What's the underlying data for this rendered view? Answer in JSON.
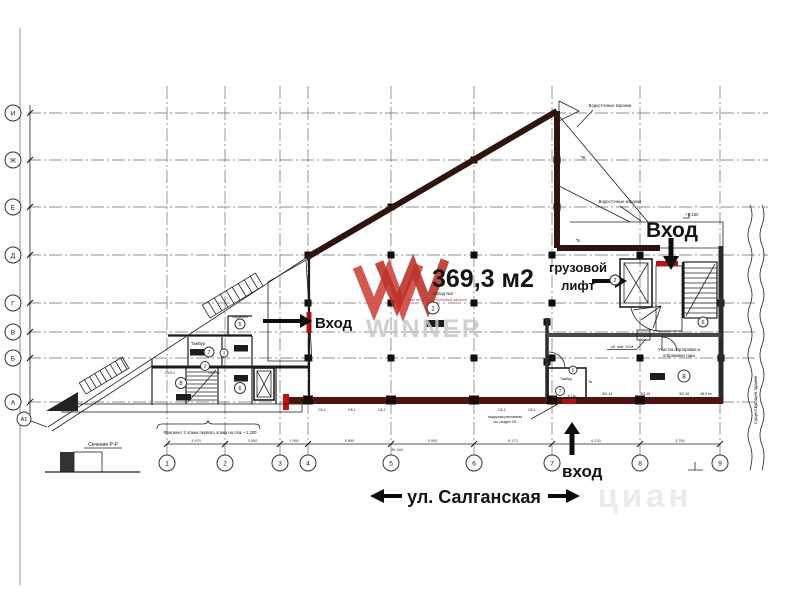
{
  "plan": {
    "area_label": "369,3 м2",
    "entrance_left": "Вход",
    "entrance_top": "Вход",
    "entrance_bottom": "вход",
    "freight_line1": "грузовой",
    "freight_line2": "лифт",
    "street_label": "ул. Салганская",
    "section_label": "Сечение Р-Р",
    "fragment_note": "Фрагмент 2 этажа первого этажа на отм. +1,200",
    "drain_note_1": "Водосточные воронки",
    "drain_note_2": "Водосточные воронки",
    "sorting_line1": "Участок сортировки и",
    "sorting_line2": "отбраковки тары",
    "tambur_left": "Тамбур",
    "tambur_right": "Тамбур",
    "garderob": "Гардероб",
    "skl1": "СКЛ-1",
    "skl12": "СКЛ-12",
    "existing_building": "Существующее здание",
    "elevation_mark": "+0,150",
    "sign_line1": "наружная рекламная",
    "sign_line2": "см. раздел СВ",
    "ob_pov": "об. пов. 2СМ",
    "area_small": "48,9 м²",
    "area_small2": "4,1 м²",
    "eo14": "ЭО-14",
    "eo15": "ЭО-15",
    "eo16": "ЭО-16",
    "tv1": "Тв",
    "tv2": "Тв",
    "tk1": "Тк"
  },
  "watermark": {
    "brand": "WINNER",
    "sub": "Склад №2",
    "disclaimer": "план не является публичной офертой",
    "faint": "циан"
  },
  "axes": {
    "columns": [
      {
        "label": "1",
        "x": 167
      },
      {
        "label": "2",
        "x": 225
      },
      {
        "label": "3",
        "x": 280
      },
      {
        "label": "4",
        "x": 308
      },
      {
        "label": "5",
        "x": 391
      },
      {
        "label": "6",
        "x": 474
      },
      {
        "label": "7",
        "x": 552
      },
      {
        "label": "8",
        "x": 640
      },
      {
        "label": "9",
        "x": 720
      }
    ],
    "rows": [
      {
        "label": "И",
        "y": 113
      },
      {
        "label": "Ж",
        "y": 160
      },
      {
        "label": "Е",
        "y": 207
      },
      {
        "label": "Д",
        "y": 255
      },
      {
        "label": "Г",
        "y": 303
      },
      {
        "label": "В",
        "y": 332
      },
      {
        "label": "Б",
        "y": 358
      },
      {
        "label": "А",
        "y": 402
      }
    ],
    "row_extra": {
      "label": "А1",
      "x": 24,
      "y": 419
    }
  },
  "dimensions": {
    "segments": [
      "4 970",
      "3 900",
      "1 980",
      "5 890",
      "5 900",
      "8 170",
      "6 220",
      "3 780"
    ],
    "total": "39 160"
  },
  "room_numbers": [
    {
      "n": "1",
      "x": 433,
      "y": 308,
      "r": 6
    },
    {
      "n": "7",
      "x": 209,
      "y": 352,
      "r": 5
    },
    {
      "n": "3",
      "x": 224,
      "y": 353,
      "r": 4
    },
    {
      "n": "5",
      "x": 240,
      "y": 324,
      "r": 5
    },
    {
      "n": "8",
      "x": 181,
      "y": 383,
      "r": 5.5
    },
    {
      "n": "6",
      "x": 240,
      "y": 388,
      "r": 5.5
    },
    {
      "n": "2",
      "x": 205,
      "y": 366,
      "r": 4.5
    },
    {
      "n": "2",
      "x": 615,
      "y": 280,
      "r": 5
    },
    {
      "n": "6",
      "x": 703,
      "y": 322,
      "r": 5
    },
    {
      "n": "8",
      "x": 684,
      "y": 376,
      "r": 6
    },
    {
      "n": "7",
      "x": 560,
      "y": 391,
      "r": 4.5
    },
    {
      "n": "5",
      "x": 573,
      "y": 370,
      "r": 4
    }
  ],
  "sk_labels": {
    "text": "СК-1",
    "xs": [
      322,
      352,
      382,
      502,
      532
    ],
    "y": 411
  },
  "colors": {
    "wall_dark": "#2f140d",
    "wall_red": "#4e1410",
    "accent_red": "#c01010",
    "logo_red": "#c4423a",
    "watermark_gray": "#c8c8c8"
  }
}
